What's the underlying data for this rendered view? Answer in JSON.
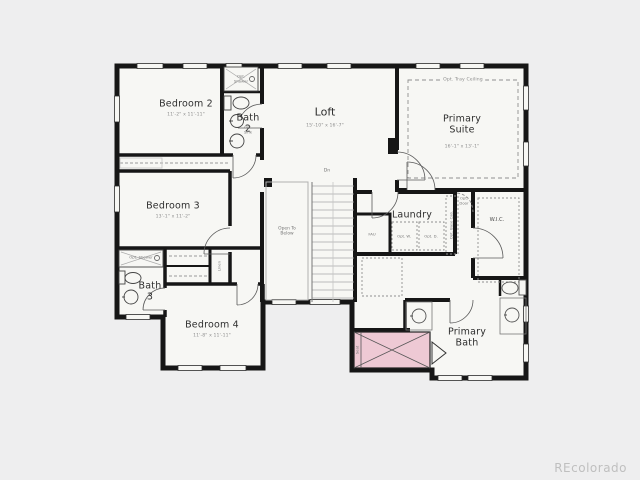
{
  "watermark": "REcolorado",
  "plan": {
    "rooms": {
      "bedroom2": {
        "name": "Bedroom 2",
        "dims": "11'-2\" x 11'-11\""
      },
      "bath2": {
        "name": "Bath 2"
      },
      "loft": {
        "name": "Loft",
        "dims": "15'-10\" x 16'-7\""
      },
      "primary_suite": {
        "name": "Primary Suite",
        "dims": "16'-1\" x 13'-1\"",
        "opt_tray": "Opt. Tray Ceiling"
      },
      "bedroom3": {
        "name": "Bedroom 3",
        "dims": "13'-1\" x 11'-2\""
      },
      "bedroom4": {
        "name": "Bedroom 4",
        "dims": "11'-8\" x 11'-11\""
      },
      "bath3": {
        "name": "Bath 3"
      },
      "laundry": {
        "name": "Laundry",
        "opt_washer": "Opt. W.",
        "opt_dryer": "Opt. D.",
        "opt_cab": "Opt. Base Cab."
      },
      "fau": {
        "name": "FAU"
      },
      "wic": {
        "name": "W.I.C."
      },
      "primary_bath": {
        "name": "Primary Bath",
        "seat": "Seat"
      }
    },
    "annotations": {
      "stairs_dn": "Dn",
      "open_below": "Open To Below",
      "opt_door": "Opt. Door",
      "linen": "Linen",
      "opt_shower": "Opt. Shower",
      "opt_sink": "Opt. Sink"
    },
    "colors": {
      "highlight": "#eec9d4",
      "wall": "#161616",
      "paper": "#f7f7f4",
      "background": "#eeeeef",
      "watermark": "#bfbfbf"
    }
  }
}
